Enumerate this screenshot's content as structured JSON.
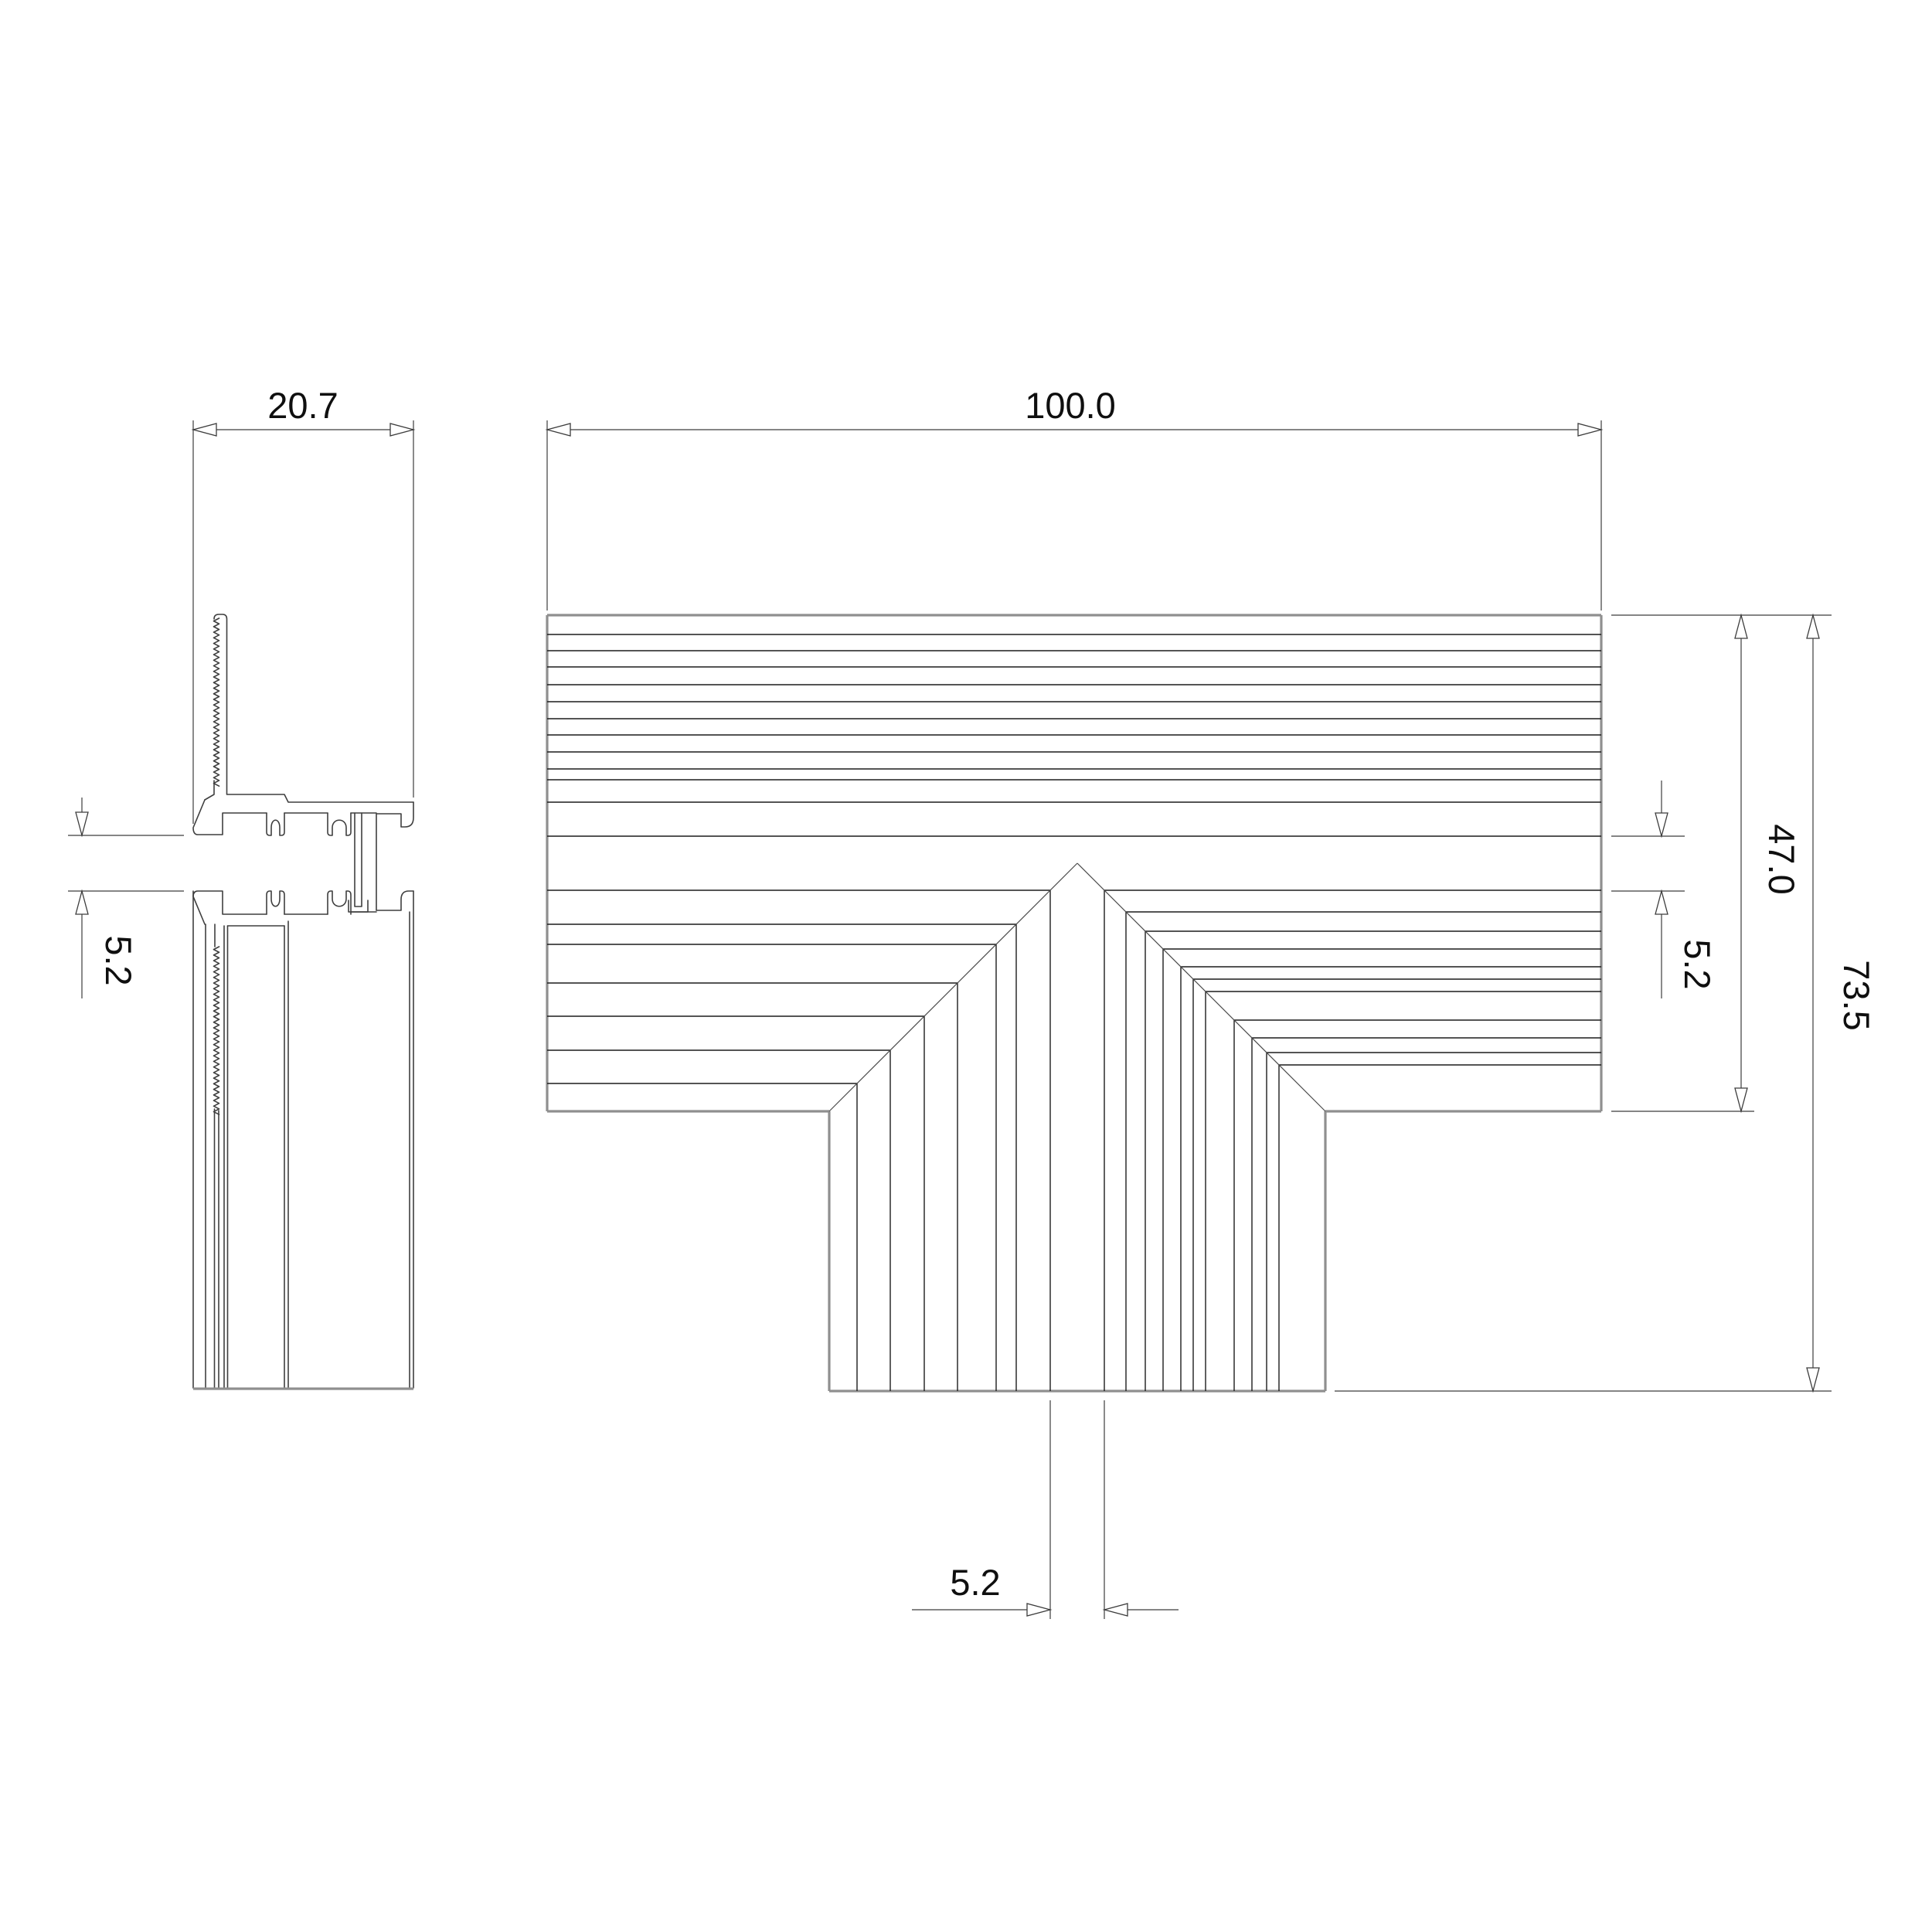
{
  "drawing": {
    "dimensions": {
      "section_width": "20.7",
      "front_width": "100.0",
      "depth": "47.0",
      "gap_right": "5.2",
      "overall_height": "73.5",
      "gap_left": "5.2",
      "center_channel": "5.2"
    },
    "colors": {
      "background": "#ffffff",
      "line": "#1c1c1c",
      "outer_edge": "#8f8f8f",
      "dimension": "#3c3c3c"
    }
  }
}
